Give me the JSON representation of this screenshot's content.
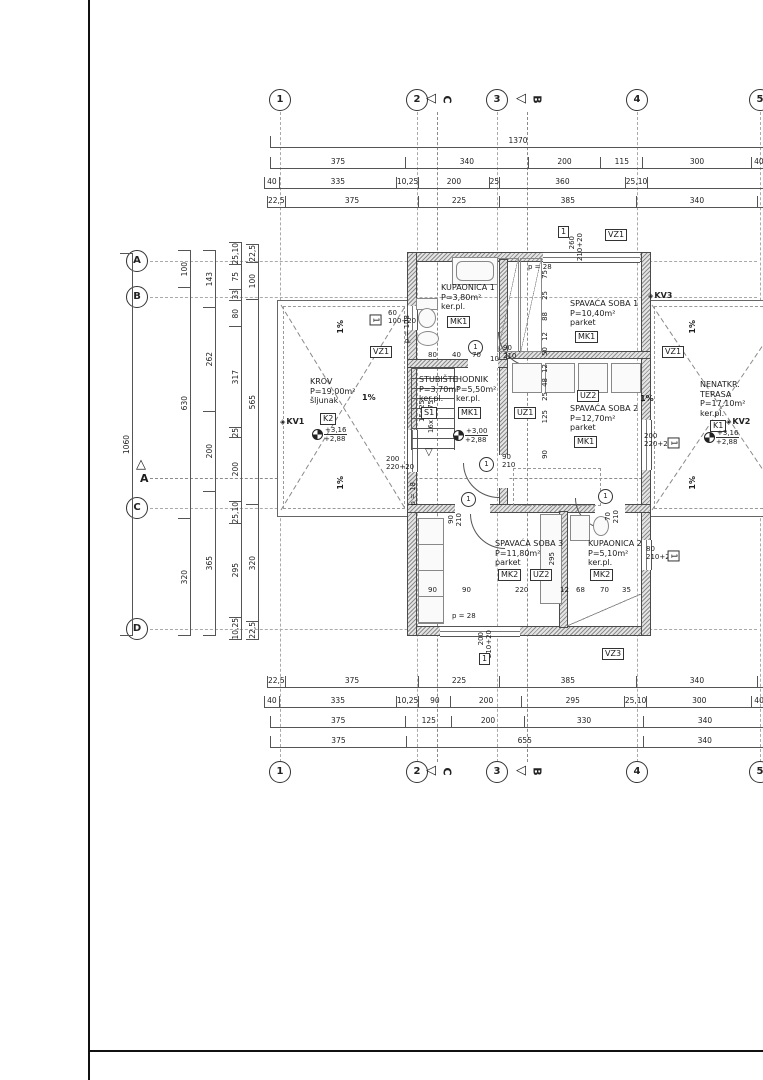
{
  "grid": {
    "cols": [
      "1",
      "2",
      "3",
      "4",
      "5"
    ],
    "rows": [
      "A",
      "B",
      "C",
      "D"
    ],
    "sec_c": "C",
    "sec_b": "B",
    "sec_a": "A"
  },
  "dims": {
    "top1": [
      "1370"
    ],
    "top2": [
      "375",
      "340",
      "200",
      "115",
      "300",
      "40"
    ],
    "top3": [
      "40",
      "335",
      "10,25",
      "200",
      "25",
      "360",
      "25,10",
      ""
    ],
    "top4": [
      "22,5",
      "375",
      "225",
      "385",
      "340",
      ""
    ],
    "bottom1": [
      "22,5",
      "375",
      "225",
      "385",
      "340",
      ""
    ],
    "bottom2": [
      "40",
      "335",
      "10,25",
      "90",
      "200",
      "295",
      "25,10",
      "300",
      "40"
    ],
    "bottom3": [
      "375",
      "125",
      "200",
      "330",
      "340"
    ],
    "bottom4": [
      "375",
      "655",
      "340"
    ],
    "left1": [
      "1060"
    ],
    "left2": [
      "100",
      "630",
      "320"
    ],
    "left3": [
      "143",
      "262",
      "200",
      "365"
    ],
    "left4": [
      "25,10",
      "75",
      "33",
      "80",
      "317",
      "25",
      "200",
      "25,10",
      "295",
      "10,25"
    ],
    "left5": [
      "22,5",
      "100",
      "565",
      "320",
      "22,5"
    ],
    "inner_top": [
      "80",
      "40",
      "70",
      "10"
    ],
    "inner_mid": [
      "75",
      "25",
      "88",
      "12",
      "50",
      "12",
      "48",
      "25",
      "125",
      "90"
    ],
    "inner_bottom": [
      "90",
      "90",
      "220",
      "12",
      "68",
      "70",
      "35"
    ],
    "uz2_h": "295"
  },
  "rooms": {
    "kupaonica1": {
      "name": "KUPAONICA 1",
      "area": "P=3,80m²",
      "floor": "ker.pl.",
      "tag": "MK1"
    },
    "spavaca1": {
      "name": "SPAVAĆA SOBA 1",
      "area": "P=10,40m²",
      "floor": "parket",
      "tag": "MK1"
    },
    "krov": {
      "name": "KROV",
      "area": "P=19,00m²",
      "floor": "šljunak",
      "tag": "K2"
    },
    "stubiste": {
      "name": "STUBIŠTE",
      "area": "P=3,70m²",
      "floor": "ker.pl.",
      "tag": "S1",
      "stair1": "15x25",
      "stair2": "16x18,75"
    },
    "hodnik": {
      "name": "HODNIK",
      "area": "P=5,50m²",
      "floor": "ker.pl.",
      "tag": "MK1"
    },
    "spavaca2": {
      "name": "SPAVAĆA SOBA 2",
      "area": "P=12,70m²",
      "floor": "parket",
      "tag": "MK1"
    },
    "terasa": {
      "name1": "NENATKR.",
      "name2": "TERASA",
      "area": "P=17,10m²",
      "floor": "ker.pl.",
      "tag": "K1"
    },
    "spavaca3": {
      "name": "SPAVAĆA SOBA 3",
      "area": "P=11,80m²",
      "floor": "parket",
      "tag": "MK2"
    },
    "kupaonica2": {
      "name": "KUPAONICA 2",
      "area": "P=5,10m²",
      "floor": "ker.pl.",
      "tag": "MK2"
    }
  },
  "levels": {
    "krov_a": "+3,16",
    "krov_b": "+2,88",
    "hodnik_a": "+3,00",
    "hodnik_b": "+2,88",
    "terasa_a": "+3,16",
    "terasa_b": "+2,88"
  },
  "markers": {
    "kv1": "KV1",
    "kv2": "KV2",
    "kv3": "KV3",
    "vz1": "VZ1",
    "vz3": "VZ3",
    "uz1": "UZ1",
    "uz2": "UZ2"
  },
  "openings": {
    "tag": "1",
    "door1_w": "90",
    "door1_h": "210",
    "door2_w": "70",
    "win_top_w": "260",
    "win_top_h": "210+20",
    "win_small_w": "60",
    "win_small_h": "100+20",
    "win_left_w": "200",
    "win_left_h": "220+20",
    "win_right_w": "200",
    "win_right_h": "220+20",
    "win_kup2_w": "80",
    "win_kup2_h": "210+20",
    "win_bot_w": "200",
    "win_bot_h": "210+20"
  },
  "notes": {
    "p28": "p = 28",
    "p18": "p = 18",
    "p108": "p = 108",
    "slope": "1%"
  }
}
